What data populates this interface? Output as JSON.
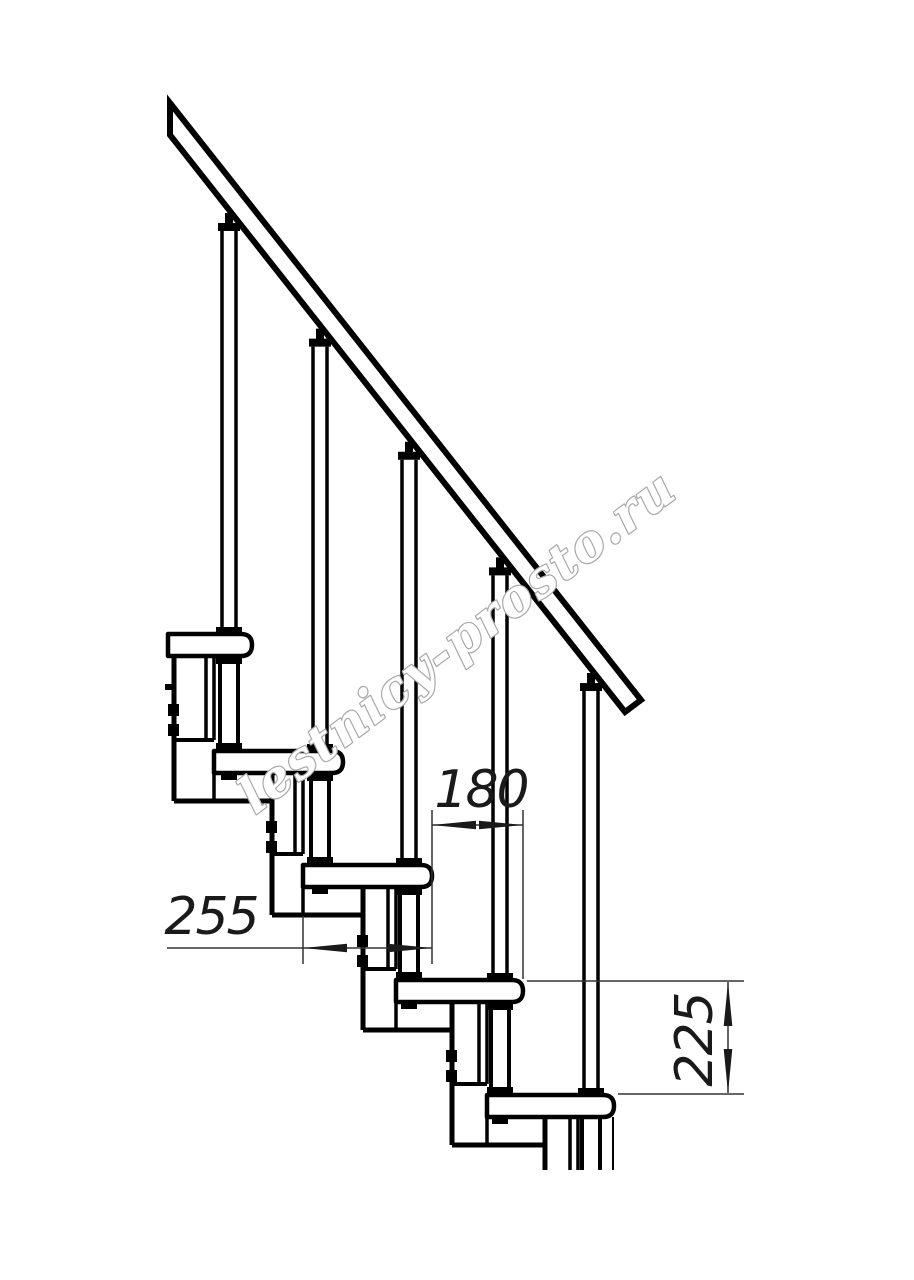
{
  "watermark": {
    "text": "lestnicy-prosto.ru",
    "color": "#a8a8a8"
  },
  "dimensions": {
    "tread_depth": {
      "value": "255"
    },
    "step_offset": {
      "value": "180"
    },
    "rise_height": {
      "value": "225"
    }
  },
  "colors": {
    "background": "#ffffff",
    "line": "#000000",
    "dimension_line": "#333333"
  }
}
